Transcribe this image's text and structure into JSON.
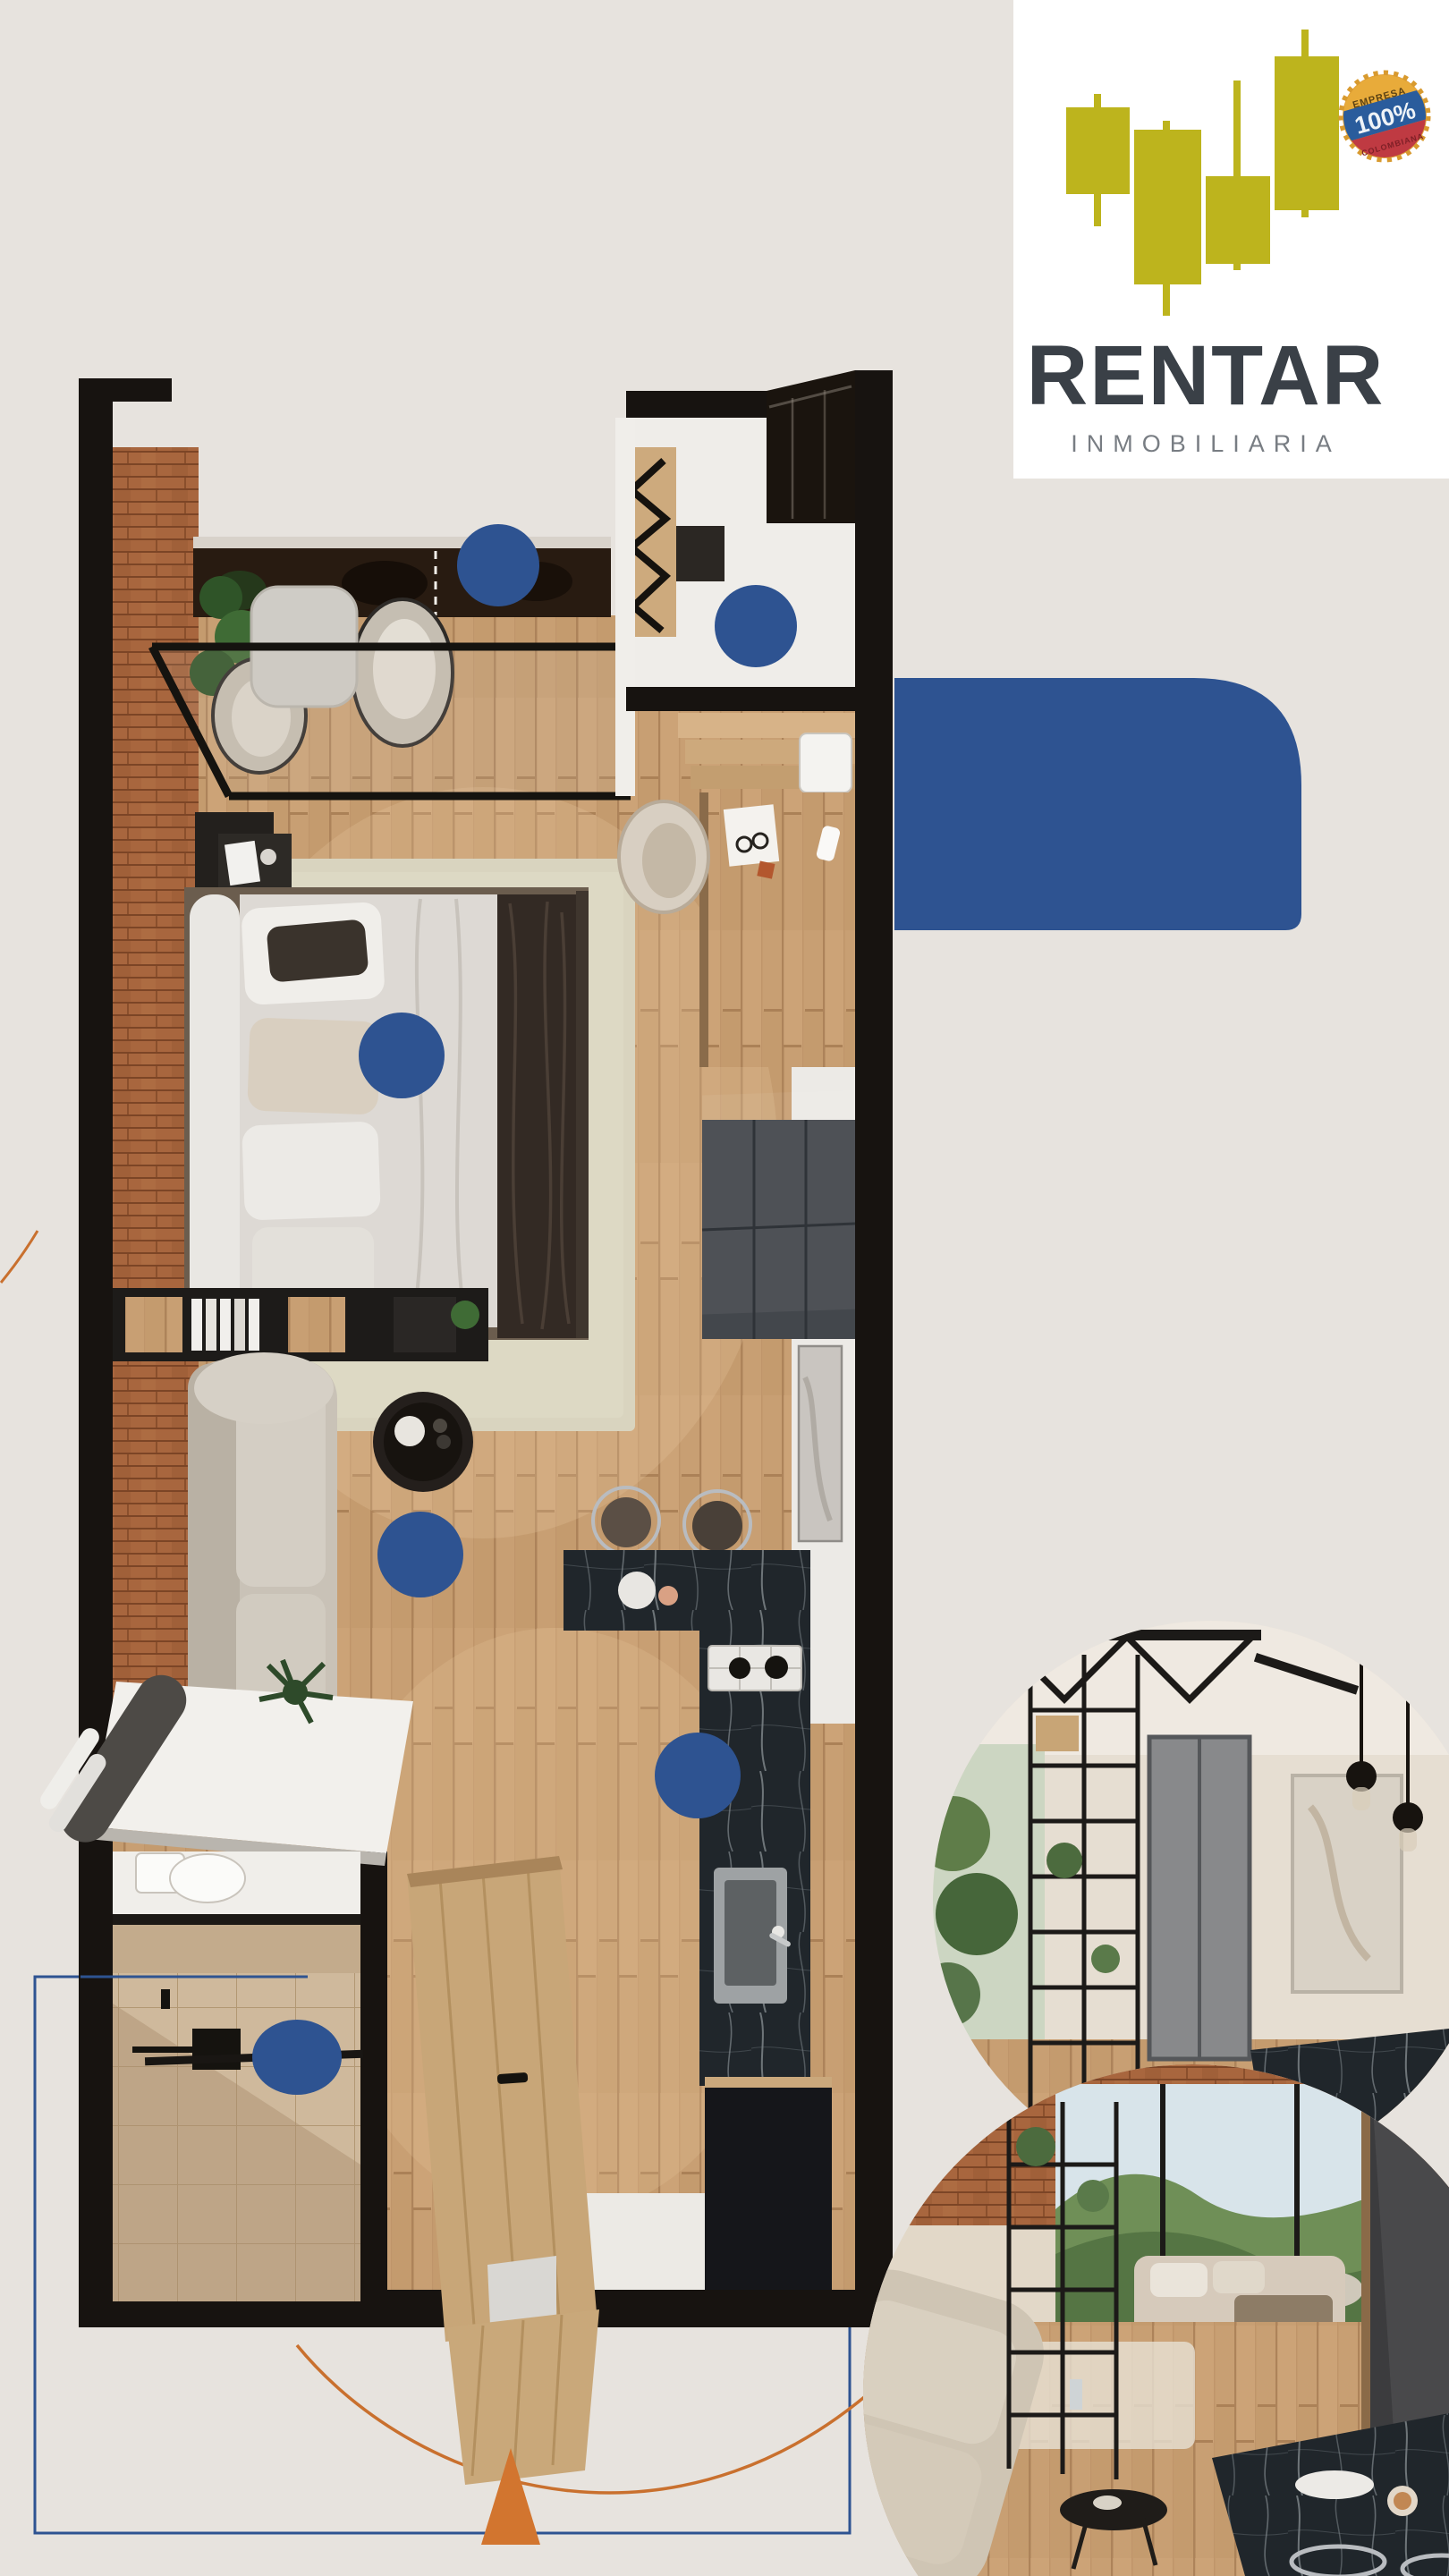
{
  "brand": {
    "name": "RENTAR",
    "tagline": "INMOBILIARIA",
    "badge": {
      "line1": "EMPRESA",
      "line2": "100%",
      "line3": "COLOMBIANA"
    }
  },
  "colors": {
    "background": "#e7e3de",
    "accent_blue": "#2e5391",
    "accent_orange": "#c9702e",
    "logo_yellow": "#bdb41d",
    "brand_text": "#3a4047",
    "wall_dark": "#171310",
    "wood_floor": "#c89f73",
    "brick": "#a8663e",
    "marble": "#20262b"
  },
  "floor_plan": {
    "type": "studio-apartment-top-view",
    "rooms": [
      "balcony",
      "entry-hall",
      "bedroom",
      "living-room",
      "kitchen",
      "bathroom"
    ],
    "markers": [
      {
        "name": "marker-balcony"
      },
      {
        "name": "marker-entry"
      },
      {
        "name": "marker-bedroom"
      },
      {
        "name": "marker-living-room"
      },
      {
        "name": "marker-kitchen"
      },
      {
        "name": "marker-bathroom"
      }
    ]
  },
  "photos": [
    {
      "name": "interior-photo-kitchen-wardrobe"
    },
    {
      "name": "interior-photo-livingroom-balcony-view"
    }
  ]
}
